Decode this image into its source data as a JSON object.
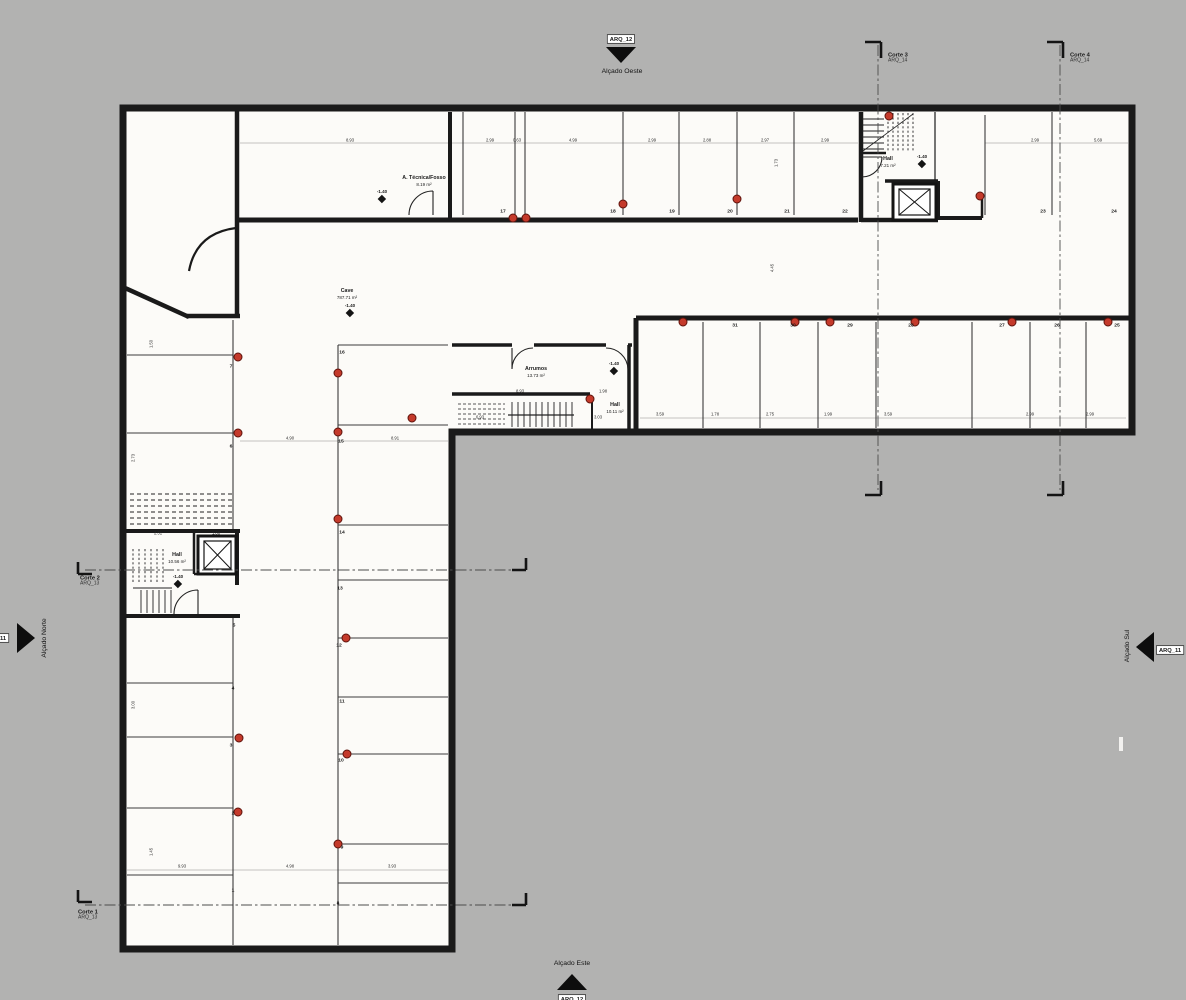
{
  "title": "Cave floor plan",
  "colors": {
    "background": "#b2b2b1",
    "plan_fill": "#fcfbf8",
    "wall": "#1a1a1a",
    "column_red": "#c43a2b"
  },
  "elevations": {
    "west": {
      "tag": "ARQ_12",
      "label": "Alçado Oeste"
    },
    "east": {
      "tag": "ARQ_12",
      "label": "Alçado Este"
    },
    "north": {
      "tag": "ARQ_11",
      "label": "Alçado Norte"
    },
    "south": {
      "tag": "ARQ_11",
      "label": "Alçado Sul"
    }
  },
  "sections": [
    {
      "name": "Corte 1",
      "tag": "ARQ_13",
      "x": 78,
      "y": 909
    },
    {
      "name": "Corte 2",
      "tag": "ARQ_13",
      "x": 80,
      "y": 575
    },
    {
      "name": "Corte 3",
      "tag": "ARQ_14",
      "x": 888,
      "y": 52
    },
    {
      "name": "Corte 4",
      "tag": "ARQ_14",
      "x": 1070,
      "y": 52
    }
  ],
  "rooms": [
    {
      "name": "A. Técnica/Fosso",
      "area": "8.19 m²",
      "x": 424,
      "y": 181
    },
    {
      "name": "Cave",
      "area": "787.71 m²",
      "x": 347,
      "y": 294
    },
    {
      "name": "Arrumos",
      "area": "13.73 m²",
      "x": 536,
      "y": 372
    },
    {
      "name": "Hall",
      "area": "7.21 m²",
      "x": 888,
      "y": 162
    },
    {
      "name": "Hall",
      "area": "10.56 m²",
      "x": 177,
      "y": 558
    },
    {
      "name": "Hall",
      "area": "10.11 m²",
      "x": 615,
      "y": 408
    }
  ],
  "levels": [
    {
      "label": "-1.40",
      "x": 382,
      "y": 202
    },
    {
      "label": "-1.40",
      "x": 350,
      "y": 316
    },
    {
      "label": "-1.40",
      "x": 614,
      "y": 374
    },
    {
      "label": "-1.40",
      "x": 922,
      "y": 167
    },
    {
      "label": "-1.40",
      "x": 178,
      "y": 587
    }
  ],
  "parking": [
    {
      "n": "17",
      "x": 503,
      "y": 211
    },
    {
      "n": "18",
      "x": 613,
      "y": 211
    },
    {
      "n": "19",
      "x": 672,
      "y": 211
    },
    {
      "n": "20",
      "x": 730,
      "y": 211
    },
    {
      "n": "21",
      "x": 787,
      "y": 211
    },
    {
      "n": "22",
      "x": 845,
      "y": 211
    },
    {
      "n": "23",
      "x": 1043,
      "y": 211
    },
    {
      "n": "24",
      "x": 1114,
      "y": 211
    },
    {
      "n": "25",
      "x": 1117,
      "y": 325
    },
    {
      "n": "26",
      "x": 1057,
      "y": 325
    },
    {
      "n": "27",
      "x": 1002,
      "y": 325
    },
    {
      "n": "28",
      "x": 911,
      "y": 325
    },
    {
      "n": "29",
      "x": 850,
      "y": 325
    },
    {
      "n": "30",
      "x": 793,
      "y": 325
    },
    {
      "n": "31",
      "x": 735,
      "y": 325
    },
    {
      "n": "16",
      "x": 342,
      "y": 352
    },
    {
      "n": "15",
      "x": 341,
      "y": 441
    },
    {
      "n": "14",
      "x": 342,
      "y": 532
    },
    {
      "n": "13",
      "x": 340,
      "y": 588
    },
    {
      "n": "12",
      "x": 339,
      "y": 645
    },
    {
      "n": "11",
      "x": 342,
      "y": 701
    },
    {
      "n": "10",
      "x": 341,
      "y": 760
    },
    {
      "n": "9",
      "x": 342,
      "y": 847
    },
    {
      "n": "8",
      "x": 338,
      "y": 903
    },
    {
      "n": "7",
      "x": 231,
      "y": 366
    },
    {
      "n": "6",
      "x": 231,
      "y": 446
    },
    {
      "n": "5",
      "x": 234,
      "y": 625
    },
    {
      "n": "4",
      "x": 233,
      "y": 688
    },
    {
      "n": "3",
      "x": 231,
      "y": 745
    },
    {
      "n": "2",
      "x": 233,
      "y": 813
    },
    {
      "n": "1",
      "x": 233,
      "y": 890
    }
  ],
  "columns": [
    {
      "x": 513,
      "y": 218
    },
    {
      "x": 526,
      "y": 218
    },
    {
      "x": 623,
      "y": 204
    },
    {
      "x": 737,
      "y": 199
    },
    {
      "x": 889,
      "y": 116
    },
    {
      "x": 980,
      "y": 196
    },
    {
      "x": 683,
      "y": 322
    },
    {
      "x": 795,
      "y": 322
    },
    {
      "x": 830,
      "y": 322
    },
    {
      "x": 915,
      "y": 322
    },
    {
      "x": 1012,
      "y": 322
    },
    {
      "x": 1108,
      "y": 322
    },
    {
      "x": 238,
      "y": 357
    },
    {
      "x": 238,
      "y": 433
    },
    {
      "x": 338,
      "y": 373
    },
    {
      "x": 338,
      "y": 432
    },
    {
      "x": 412,
      "y": 418
    },
    {
      "x": 338,
      "y": 519
    },
    {
      "x": 346,
      "y": 638
    },
    {
      "x": 347,
      "y": 754
    },
    {
      "x": 338,
      "y": 844
    },
    {
      "x": 239,
      "y": 738
    },
    {
      "x": 238,
      "y": 812
    },
    {
      "x": 590,
      "y": 399
    }
  ],
  "dimensions": [
    {
      "t": "8.93",
      "x": 350,
      "y": 140
    },
    {
      "t": "2.99",
      "x": 490,
      "y": 140
    },
    {
      "t": "0.63",
      "x": 517,
      "y": 140
    },
    {
      "t": "4.99",
      "x": 573,
      "y": 140
    },
    {
      "t": "2.99",
      "x": 652,
      "y": 140
    },
    {
      "t": "2.88",
      "x": 707,
      "y": 140
    },
    {
      "t": "2.97",
      "x": 765,
      "y": 140
    },
    {
      "t": "2.99",
      "x": 825,
      "y": 140
    },
    {
      "t": "2.99",
      "x": 1035,
      "y": 140
    },
    {
      "t": "5.69",
      "x": 1098,
      "y": 140
    },
    {
      "t": "1.73",
      "x": 776,
      "y": 163,
      "cls": "v"
    },
    {
      "t": "4.45",
      "x": 772,
      "y": 268,
      "cls": "v"
    },
    {
      "t": "3.59",
      "x": 660,
      "y": 414
    },
    {
      "t": "1.78",
      "x": 715,
      "y": 414
    },
    {
      "t": "2.75",
      "x": 770,
      "y": 414
    },
    {
      "t": "1.99",
      "x": 828,
      "y": 414
    },
    {
      "t": "3.59",
      "x": 888,
      "y": 414
    },
    {
      "t": "2.99",
      "x": 1030,
      "y": 414
    },
    {
      "t": "2.99",
      "x": 1090,
      "y": 414
    },
    {
      "t": "8.93",
      "x": 520,
      "y": 391
    },
    {
      "t": "1.98",
      "x": 603,
      "y": 391
    },
    {
      "t": "6.93",
      "x": 480,
      "y": 417
    },
    {
      "t": "3.03",
      "x": 598,
      "y": 417
    },
    {
      "t": "4.90",
      "x": 290,
      "y": 438
    },
    {
      "t": "8.91",
      "x": 395,
      "y": 438
    },
    {
      "t": "2.31",
      "x": 158,
      "y": 533
    },
    {
      "t": "1.88",
      "x": 216,
      "y": 533
    },
    {
      "t": "9.93",
      "x": 182,
      "y": 866
    },
    {
      "t": "4.98",
      "x": 290,
      "y": 866
    },
    {
      "t": "3.93",
      "x": 392,
      "y": 866
    },
    {
      "t": "1.50",
      "x": 151,
      "y": 344,
      "cls": "v"
    },
    {
      "t": "2.73",
      "x": 133,
      "y": 458,
      "cls": "v"
    },
    {
      "t": "3.00",
      "x": 133,
      "y": 705,
      "cls": "v"
    },
    {
      "t": "1.45",
      "x": 151,
      "y": 852,
      "cls": "v"
    }
  ]
}
